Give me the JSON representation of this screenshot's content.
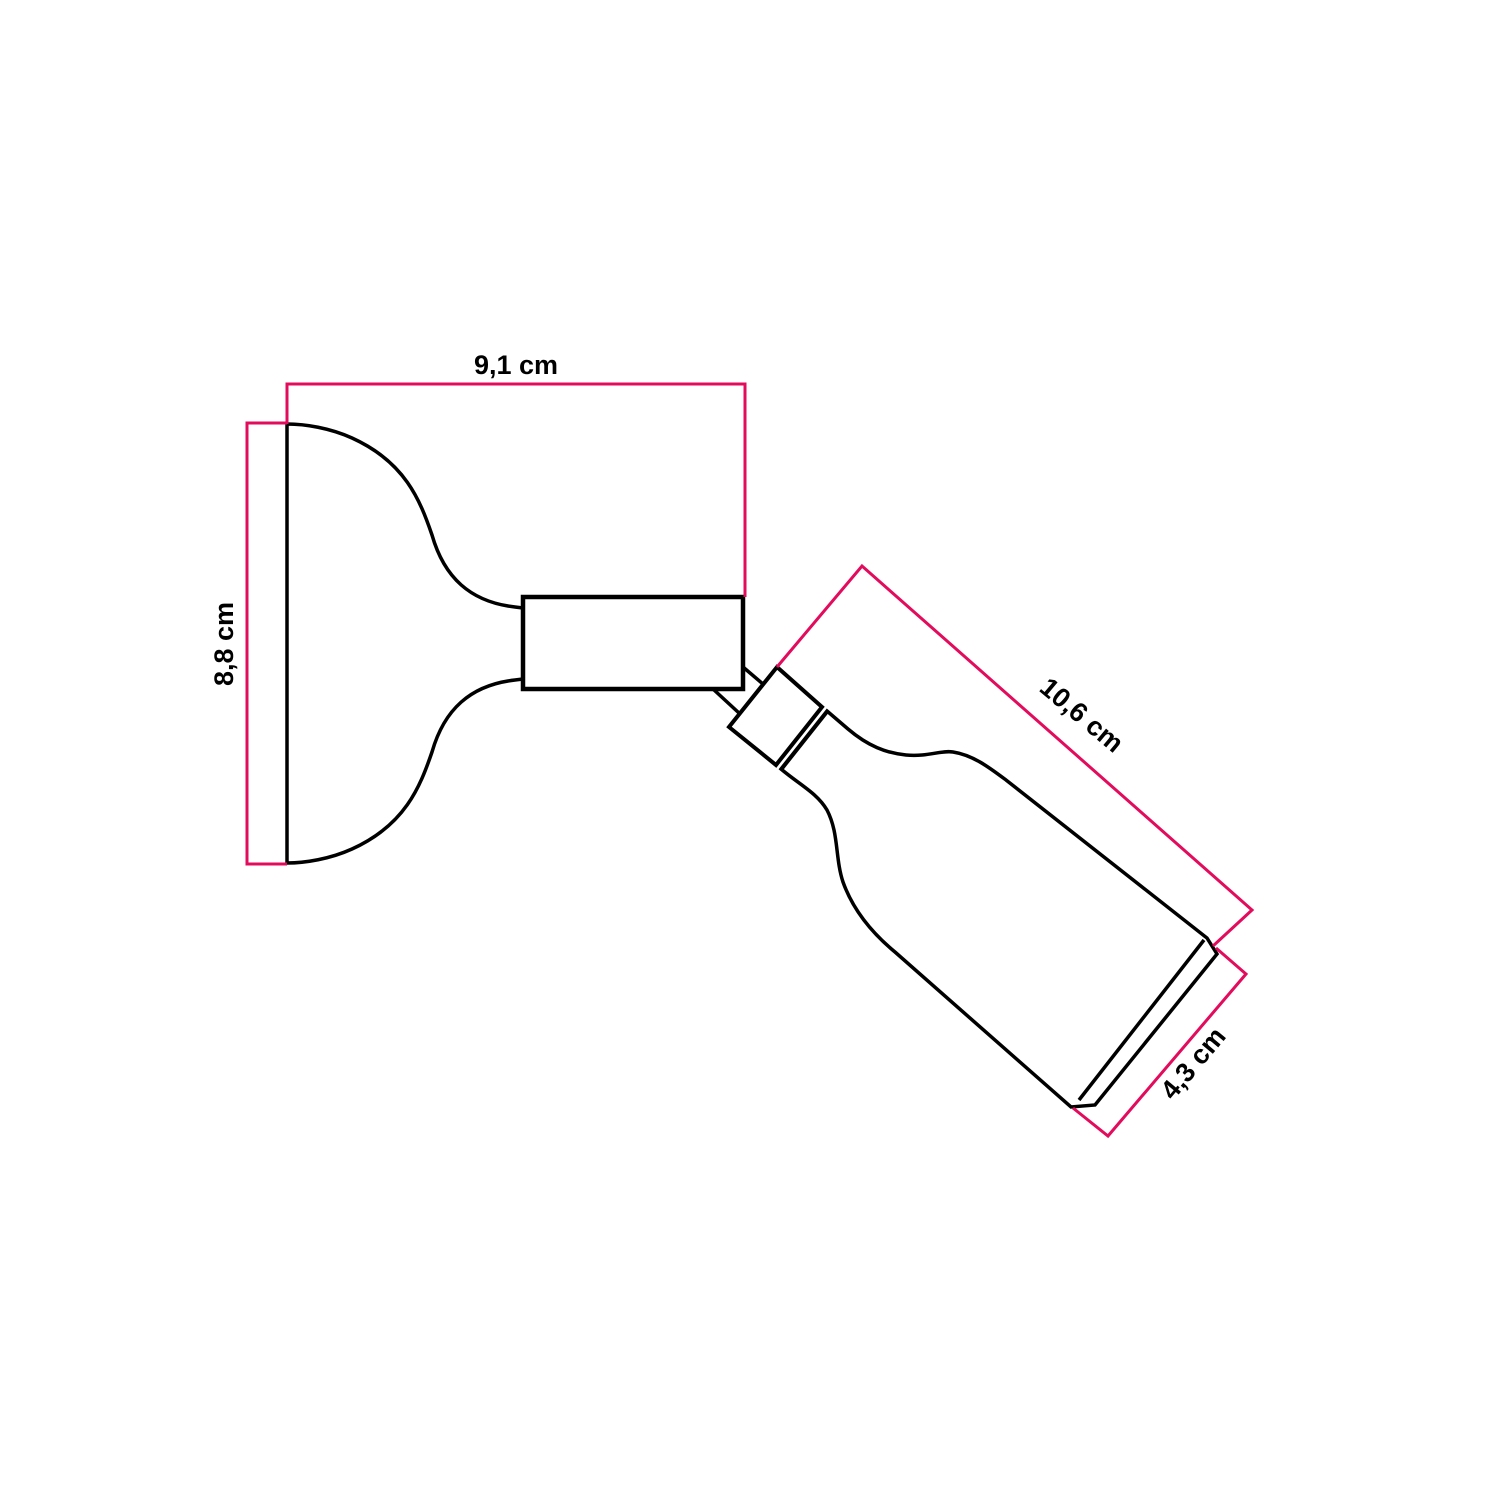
{
  "diagram": {
    "kind": "product-dimension-drawing",
    "unit": "cm",
    "colors": {
      "outline": "#000000",
      "dimension": "#e20b5c",
      "background": "#ffffff"
    },
    "dimensions": [
      {
        "id": "width",
        "label": "9,1 cm",
        "value_cm": 9.1
      },
      {
        "id": "height",
        "label": "8,8 cm",
        "value_cm": 8.8
      },
      {
        "id": "length",
        "label": "10,6 cm",
        "value_cm": 10.6
      },
      {
        "id": "diameter",
        "label": "4,3 cm",
        "value_cm": 4.3
      }
    ]
  }
}
